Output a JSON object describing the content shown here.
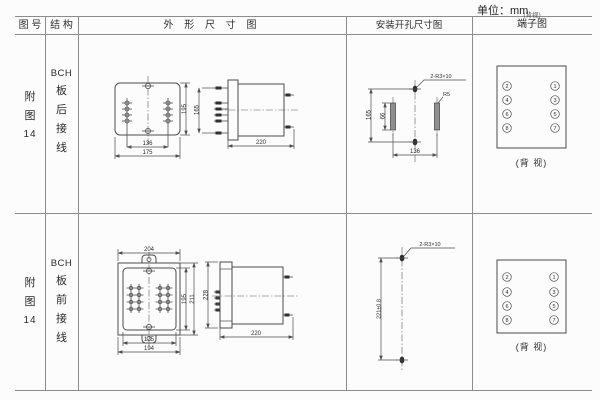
{
  "page": {
    "unit": "单位：mm"
  },
  "header": {
    "col_figure": "图 号",
    "col_structure": "结 构",
    "col_outline": "外 形 尺 寸 图",
    "col_install": "安装开孔尺寸图",
    "col_terminal": "端子图",
    "col_terminal_note": "(背视)"
  },
  "rows": [
    {
      "figure_no": [
        "附",
        "图",
        "14"
      ],
      "structure": [
        "BCH",
        "板",
        "后",
        "接",
        "线"
      ],
      "outline": {
        "width_inner": "136",
        "width_outer": "175",
        "height": "195",
        "side_span": "165",
        "depth": "220"
      },
      "install": {
        "holes": "2-R3×10",
        "radius": "R5",
        "height": "165",
        "slot": "66",
        "width": "136"
      },
      "terminal": {
        "left": [
          "2",
          "4",
          "6",
          "8"
        ],
        "right": [
          "1",
          "3",
          "5",
          "7"
        ],
        "caption": "(背 视)"
      }
    },
    {
      "figure_no": [
        "附",
        "图",
        "14"
      ],
      "structure": [
        "BCH",
        "板",
        "前",
        "接",
        "线"
      ],
      "outline": {
        "top": "204",
        "height_inner": "195",
        "height_outer": "211",
        "width_inner": "175",
        "width_outer": "194",
        "side_height": "228",
        "depth": "220"
      },
      "install": {
        "holes": "2-R3×10",
        "height": "221±0.8"
      },
      "terminal": {
        "left": [
          "2",
          "4",
          "6",
          "8"
        ],
        "right": [
          "1",
          "3",
          "5",
          "7"
        ],
        "caption": "(背 视)"
      }
    }
  ]
}
